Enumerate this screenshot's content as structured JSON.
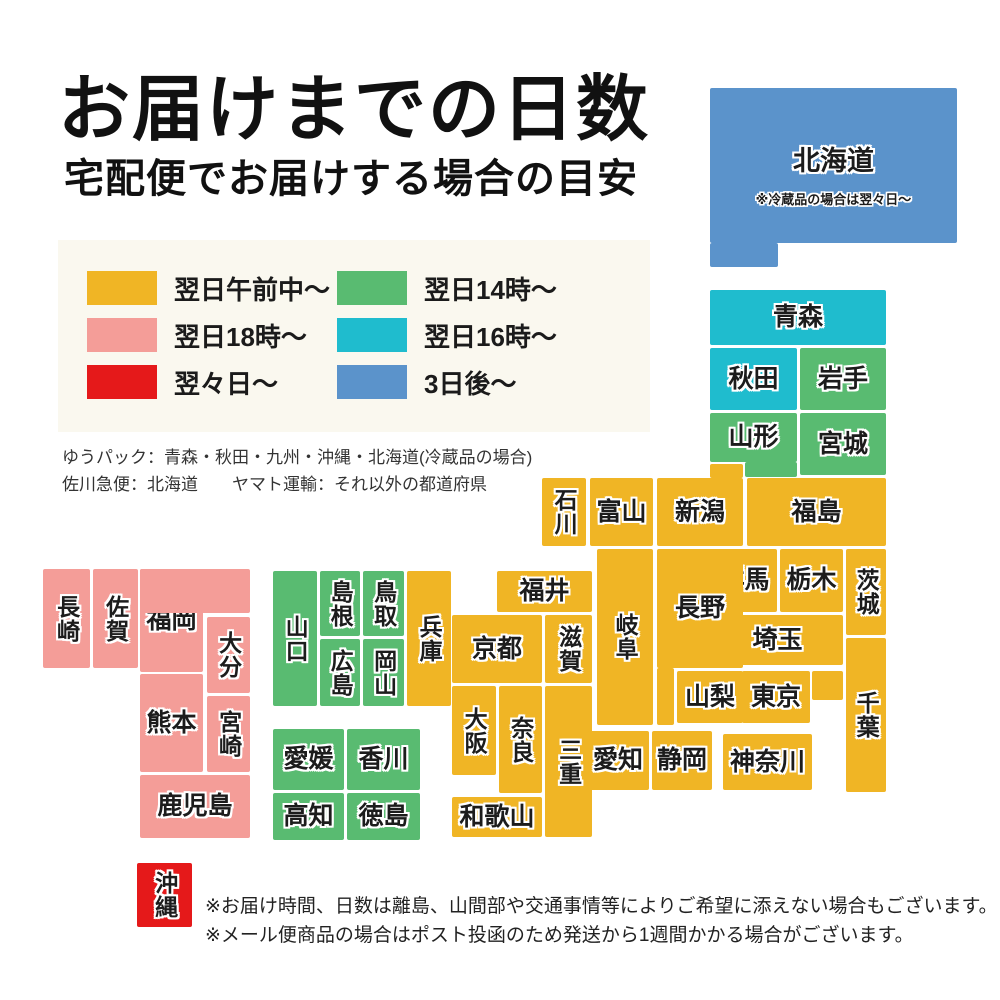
{
  "palette": {
    "yellow": "#f0b525",
    "pink": "#f49d98",
    "red": "#e5191a",
    "green": "#59bb71",
    "cyan": "#1fbcce",
    "blue": "#5b93cb"
  },
  "header": {
    "title": "お届けまでの日数",
    "subtitle": "宅配便でお届けする場合の目安"
  },
  "legend": {
    "items": [
      {
        "label": "翌日午前中〜",
        "color": "yellow"
      },
      {
        "label": "翌日18時〜",
        "color": "pink"
      },
      {
        "label": "翌々日〜",
        "color": "red"
      },
      {
        "label": "翌日14時〜",
        "color": "green"
      },
      {
        "label": "翌日16時〜",
        "color": "cyan"
      },
      {
        "label": "3日後〜",
        "color": "blue"
      }
    ]
  },
  "carrier_notes": [
    "ゆうパック：青森・秋田・九州・沖縄・北海道(冷蔵品の場合)",
    "佐川急便：北海道　　ヤマト運輸：それ以外の都道府県"
  ],
  "map": {
    "prefectures": [
      {
        "id": "hokkaido",
        "name": "北海道",
        "color": "blue",
        "vertical": false,
        "note": "※冷蔵品の場合は翌々日〜",
        "rects": [
          [
            710,
            88,
            247,
            155
          ],
          [
            710,
            243,
            68,
            24
          ]
        ]
      },
      {
        "id": "aomori",
        "name": "青森",
        "color": "cyan",
        "vertical": false,
        "rects": [
          [
            710,
            290,
            176,
            55
          ]
        ]
      },
      {
        "id": "akita",
        "name": "秋田",
        "color": "cyan",
        "vertical": false,
        "rects": [
          [
            710,
            348,
            87,
            62
          ]
        ]
      },
      {
        "id": "iwate",
        "name": "岩手",
        "color": "green",
        "vertical": false,
        "rects": [
          [
            800,
            348,
            86,
            62
          ]
        ]
      },
      {
        "id": "yamagata",
        "name": "山形",
        "color": "green",
        "vertical": false,
        "rects": [
          [
            710,
            413,
            87,
            49
          ],
          [
            745,
            462,
            52,
            15
          ]
        ]
      },
      {
        "id": "miyagi",
        "name": "宮城",
        "color": "green",
        "vertical": false,
        "rects": [
          [
            800,
            413,
            86,
            62
          ]
        ]
      },
      {
        "id": "niigata",
        "name": "新潟",
        "color": "yellow",
        "vertical": false,
        "rects": [
          [
            657,
            478,
            86,
            68
          ],
          [
            710,
            464,
            33,
            14
          ]
        ]
      },
      {
        "id": "ishikawa",
        "name": "石川",
        "color": "yellow",
        "vertical": true,
        "rects": [
          [
            542,
            478,
            44,
            68
          ]
        ]
      },
      {
        "id": "toyama",
        "name": "富山",
        "color": "yellow",
        "vertical": false,
        "rects": [
          [
            590,
            478,
            63,
            68
          ]
        ]
      },
      {
        "id": "fukushima",
        "name": "福島",
        "color": "yellow",
        "vertical": false,
        "rects": [
          [
            747,
            478,
            139,
            68
          ]
        ]
      },
      {
        "id": "gunma",
        "name": "群馬",
        "color": "yellow",
        "vertical": false,
        "rects": [
          [
            712,
            549,
            65,
            63
          ]
        ]
      },
      {
        "id": "tochigi",
        "name": "栃木",
        "color": "yellow",
        "vertical": false,
        "rects": [
          [
            780,
            549,
            63,
            63
          ]
        ]
      },
      {
        "id": "ibaraki",
        "name": "茨城",
        "color": "yellow",
        "vertical": true,
        "rects": [
          [
            846,
            549,
            40,
            86
          ]
        ]
      },
      {
        "id": "saitama",
        "name": "埼玉",
        "color": "yellow",
        "vertical": false,
        "rects": [
          [
            712,
            615,
            131,
            50
          ]
        ]
      },
      {
        "id": "chiba",
        "name": "千葉",
        "color": "yellow",
        "vertical": true,
        "rects": [
          [
            846,
            638,
            40,
            154
          ]
        ]
      },
      {
        "id": "yamanashi",
        "name": "山梨",
        "color": "yellow",
        "vertical": false,
        "rects": [
          [
            677,
            671,
            66,
            52
          ]
        ]
      },
      {
        "id": "tokyo",
        "name": "東京",
        "color": "yellow",
        "vertical": false,
        "rects": [
          [
            742,
            671,
            68,
            52
          ],
          [
            812,
            671,
            31,
            29
          ]
        ]
      },
      {
        "id": "kanagawa",
        "name": "神奈川",
        "color": "yellow",
        "vertical": false,
        "rects": [
          [
            723,
            734,
            89,
            56
          ]
        ]
      },
      {
        "id": "nagano",
        "name": "長野",
        "color": "yellow",
        "vertical": false,
        "rects": [
          [
            657,
            549,
            86,
            119
          ],
          [
            657,
            668,
            17,
            57
          ]
        ]
      },
      {
        "id": "gifu",
        "name": "岐阜",
        "color": "yellow",
        "vertical": true,
        "rects": [
          [
            597,
            549,
            56,
            176
          ]
        ]
      },
      {
        "id": "fukui",
        "name": "福井",
        "color": "yellow",
        "vertical": false,
        "rects": [
          [
            497,
            571,
            95,
            41
          ]
        ]
      },
      {
        "id": "shiga",
        "name": "滋賀",
        "color": "yellow",
        "vertical": true,
        "rects": [
          [
            545,
            615,
            47,
            68
          ]
        ]
      },
      {
        "id": "kyoto",
        "name": "京都",
        "color": "yellow",
        "vertical": false,
        "rects": [
          [
            452,
            615,
            90,
            68
          ]
        ]
      },
      {
        "id": "osaka",
        "name": "大阪",
        "color": "yellow",
        "vertical": true,
        "rects": [
          [
            452,
            686,
            44,
            89
          ]
        ]
      },
      {
        "id": "nara",
        "name": "奈良",
        "color": "yellow",
        "vertical": true,
        "rects": [
          [
            499,
            686,
            43,
            107
          ]
        ]
      },
      {
        "id": "mie",
        "name": "三重",
        "color": "yellow",
        "vertical": true,
        "rects": [
          [
            545,
            686,
            47,
            151
          ]
        ]
      },
      {
        "id": "wakayama",
        "name": "和歌山",
        "color": "yellow",
        "vertical": false,
        "rects": [
          [
            452,
            797,
            90,
            40
          ]
        ]
      },
      {
        "id": "aichi",
        "name": "愛知",
        "color": "yellow",
        "vertical": false,
        "rects": [
          [
            587,
            731,
            62,
            59
          ]
        ]
      },
      {
        "id": "shizuoka",
        "name": "静岡",
        "color": "yellow",
        "vertical": false,
        "rects": [
          [
            652,
            731,
            60,
            59
          ]
        ]
      },
      {
        "id": "hyogo",
        "name": "兵庫",
        "color": "yellow",
        "vertical": true,
        "rects": [
          [
            407,
            571,
            44,
            135
          ]
        ]
      },
      {
        "id": "yamaguchi",
        "name": "山口",
        "color": "green",
        "vertical": true,
        "rects": [
          [
            273,
            571,
            44,
            135
          ]
        ]
      },
      {
        "id": "shimane",
        "name": "島根",
        "color": "green",
        "vertical": true,
        "rects": [
          [
            320,
            571,
            40,
            65
          ]
        ]
      },
      {
        "id": "tottori",
        "name": "鳥取",
        "color": "green",
        "vertical": true,
        "rects": [
          [
            363,
            571,
            41,
            65
          ]
        ]
      },
      {
        "id": "hiroshima",
        "name": "広島",
        "color": "green",
        "vertical": true,
        "rects": [
          [
            320,
            639,
            40,
            67
          ]
        ]
      },
      {
        "id": "okayama",
        "name": "岡山",
        "color": "green",
        "vertical": true,
        "rects": [
          [
            363,
            639,
            41,
            67
          ]
        ]
      },
      {
        "id": "ehime",
        "name": "愛媛",
        "color": "green",
        "vertical": false,
        "rects": [
          [
            273,
            729,
            71,
            61
          ]
        ]
      },
      {
        "id": "kagawa",
        "name": "香川",
        "color": "green",
        "vertical": false,
        "rects": [
          [
            347,
            729,
            73,
            61
          ]
        ]
      },
      {
        "id": "kochi",
        "name": "高知",
        "color": "green",
        "vertical": false,
        "rects": [
          [
            273,
            793,
            71,
            47
          ]
        ]
      },
      {
        "id": "tokushima",
        "name": "徳島",
        "color": "green",
        "vertical": false,
        "rects": [
          [
            347,
            793,
            73,
            47
          ]
        ]
      },
      {
        "id": "nagasaki",
        "name": "長崎",
        "color": "pink",
        "vertical": true,
        "rects": [
          [
            43,
            569,
            47,
            99
          ]
        ]
      },
      {
        "id": "saga",
        "name": "佐賀",
        "color": "pink",
        "vertical": true,
        "rects": [
          [
            93,
            569,
            45,
            99
          ]
        ]
      },
      {
        "id": "fukuoka",
        "name": "福岡",
        "color": "pink",
        "vertical": false,
        "rects": [
          [
            140,
            569,
            63,
            103
          ],
          [
            140,
            569,
            110,
            44
          ]
        ]
      },
      {
        "id": "oita",
        "name": "大分",
        "color": "pink",
        "vertical": true,
        "rects": [
          [
            207,
            617,
            43,
            76
          ]
        ]
      },
      {
        "id": "kumamoto",
        "name": "熊本",
        "color": "pink",
        "vertical": false,
        "rects": [
          [
            140,
            674,
            63,
            98
          ]
        ]
      },
      {
        "id": "miyazaki",
        "name": "宮崎",
        "color": "pink",
        "vertical": true,
        "rects": [
          [
            207,
            696,
            43,
            76
          ]
        ]
      },
      {
        "id": "kagoshima",
        "name": "鹿児島",
        "color": "pink",
        "vertical": false,
        "rects": [
          [
            140,
            775,
            110,
            63
          ]
        ]
      },
      {
        "id": "okinawa",
        "name": "沖縄",
        "color": "red",
        "vertical": true,
        "rects": [
          [
            137,
            863,
            55,
            64
          ]
        ]
      }
    ]
  },
  "bottom_notes": [
    "※お届け時間、日数は離島、山間部や交通事情等によりご希望に添えない場合もございます。",
    "※メール便商品の場合はポスト投函のため発送から1週間かかる場合がございます。"
  ]
}
